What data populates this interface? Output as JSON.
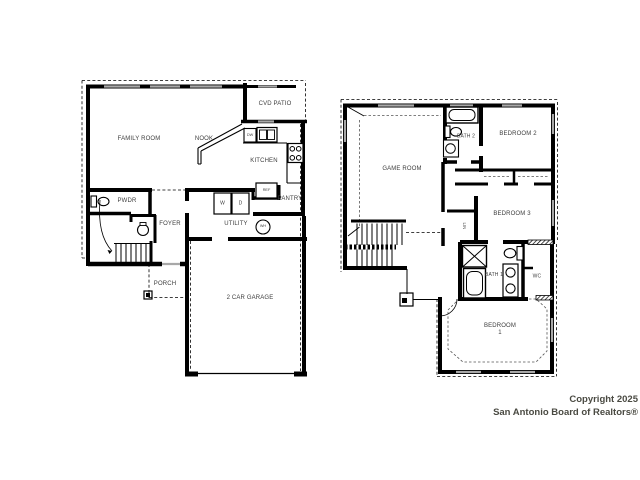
{
  "colors": {
    "wall": "#000000",
    "window": "#a8a8a8",
    "label": "#3d3d3d",
    "watermark": "#4a4a42",
    "background": "#ffffff"
  },
  "first_floor": {
    "family_room": "FAMILY ROOM",
    "nook": "NOOK",
    "cvd_patio": "CVD PATIO",
    "kitchen": "KITCHEN",
    "pwdr": "PWDR",
    "foyer": "FOYER",
    "utility": "UTILITY",
    "pantry": "PANTRY",
    "ref": "REF",
    "porch": "PORCH",
    "garage": "2 CAR GARAGE",
    "washer": "W",
    "dryer": "D",
    "dishwasher": "DW",
    "water_heater": "WH"
  },
  "second_floor": {
    "game_room": "GAME ROOM",
    "bath_2": "BATH 2",
    "bedroom_2": "BEDROOM 2",
    "bedroom_3": "BEDROOM 3",
    "bath_1": "BATH 1",
    "wc": "WC",
    "bedroom_1": "BEDROOM 1",
    "linen": "LIN"
  },
  "watermark": {
    "line1": "Copyright 2025",
    "line2": "San Antonio Board of Realtors®"
  }
}
